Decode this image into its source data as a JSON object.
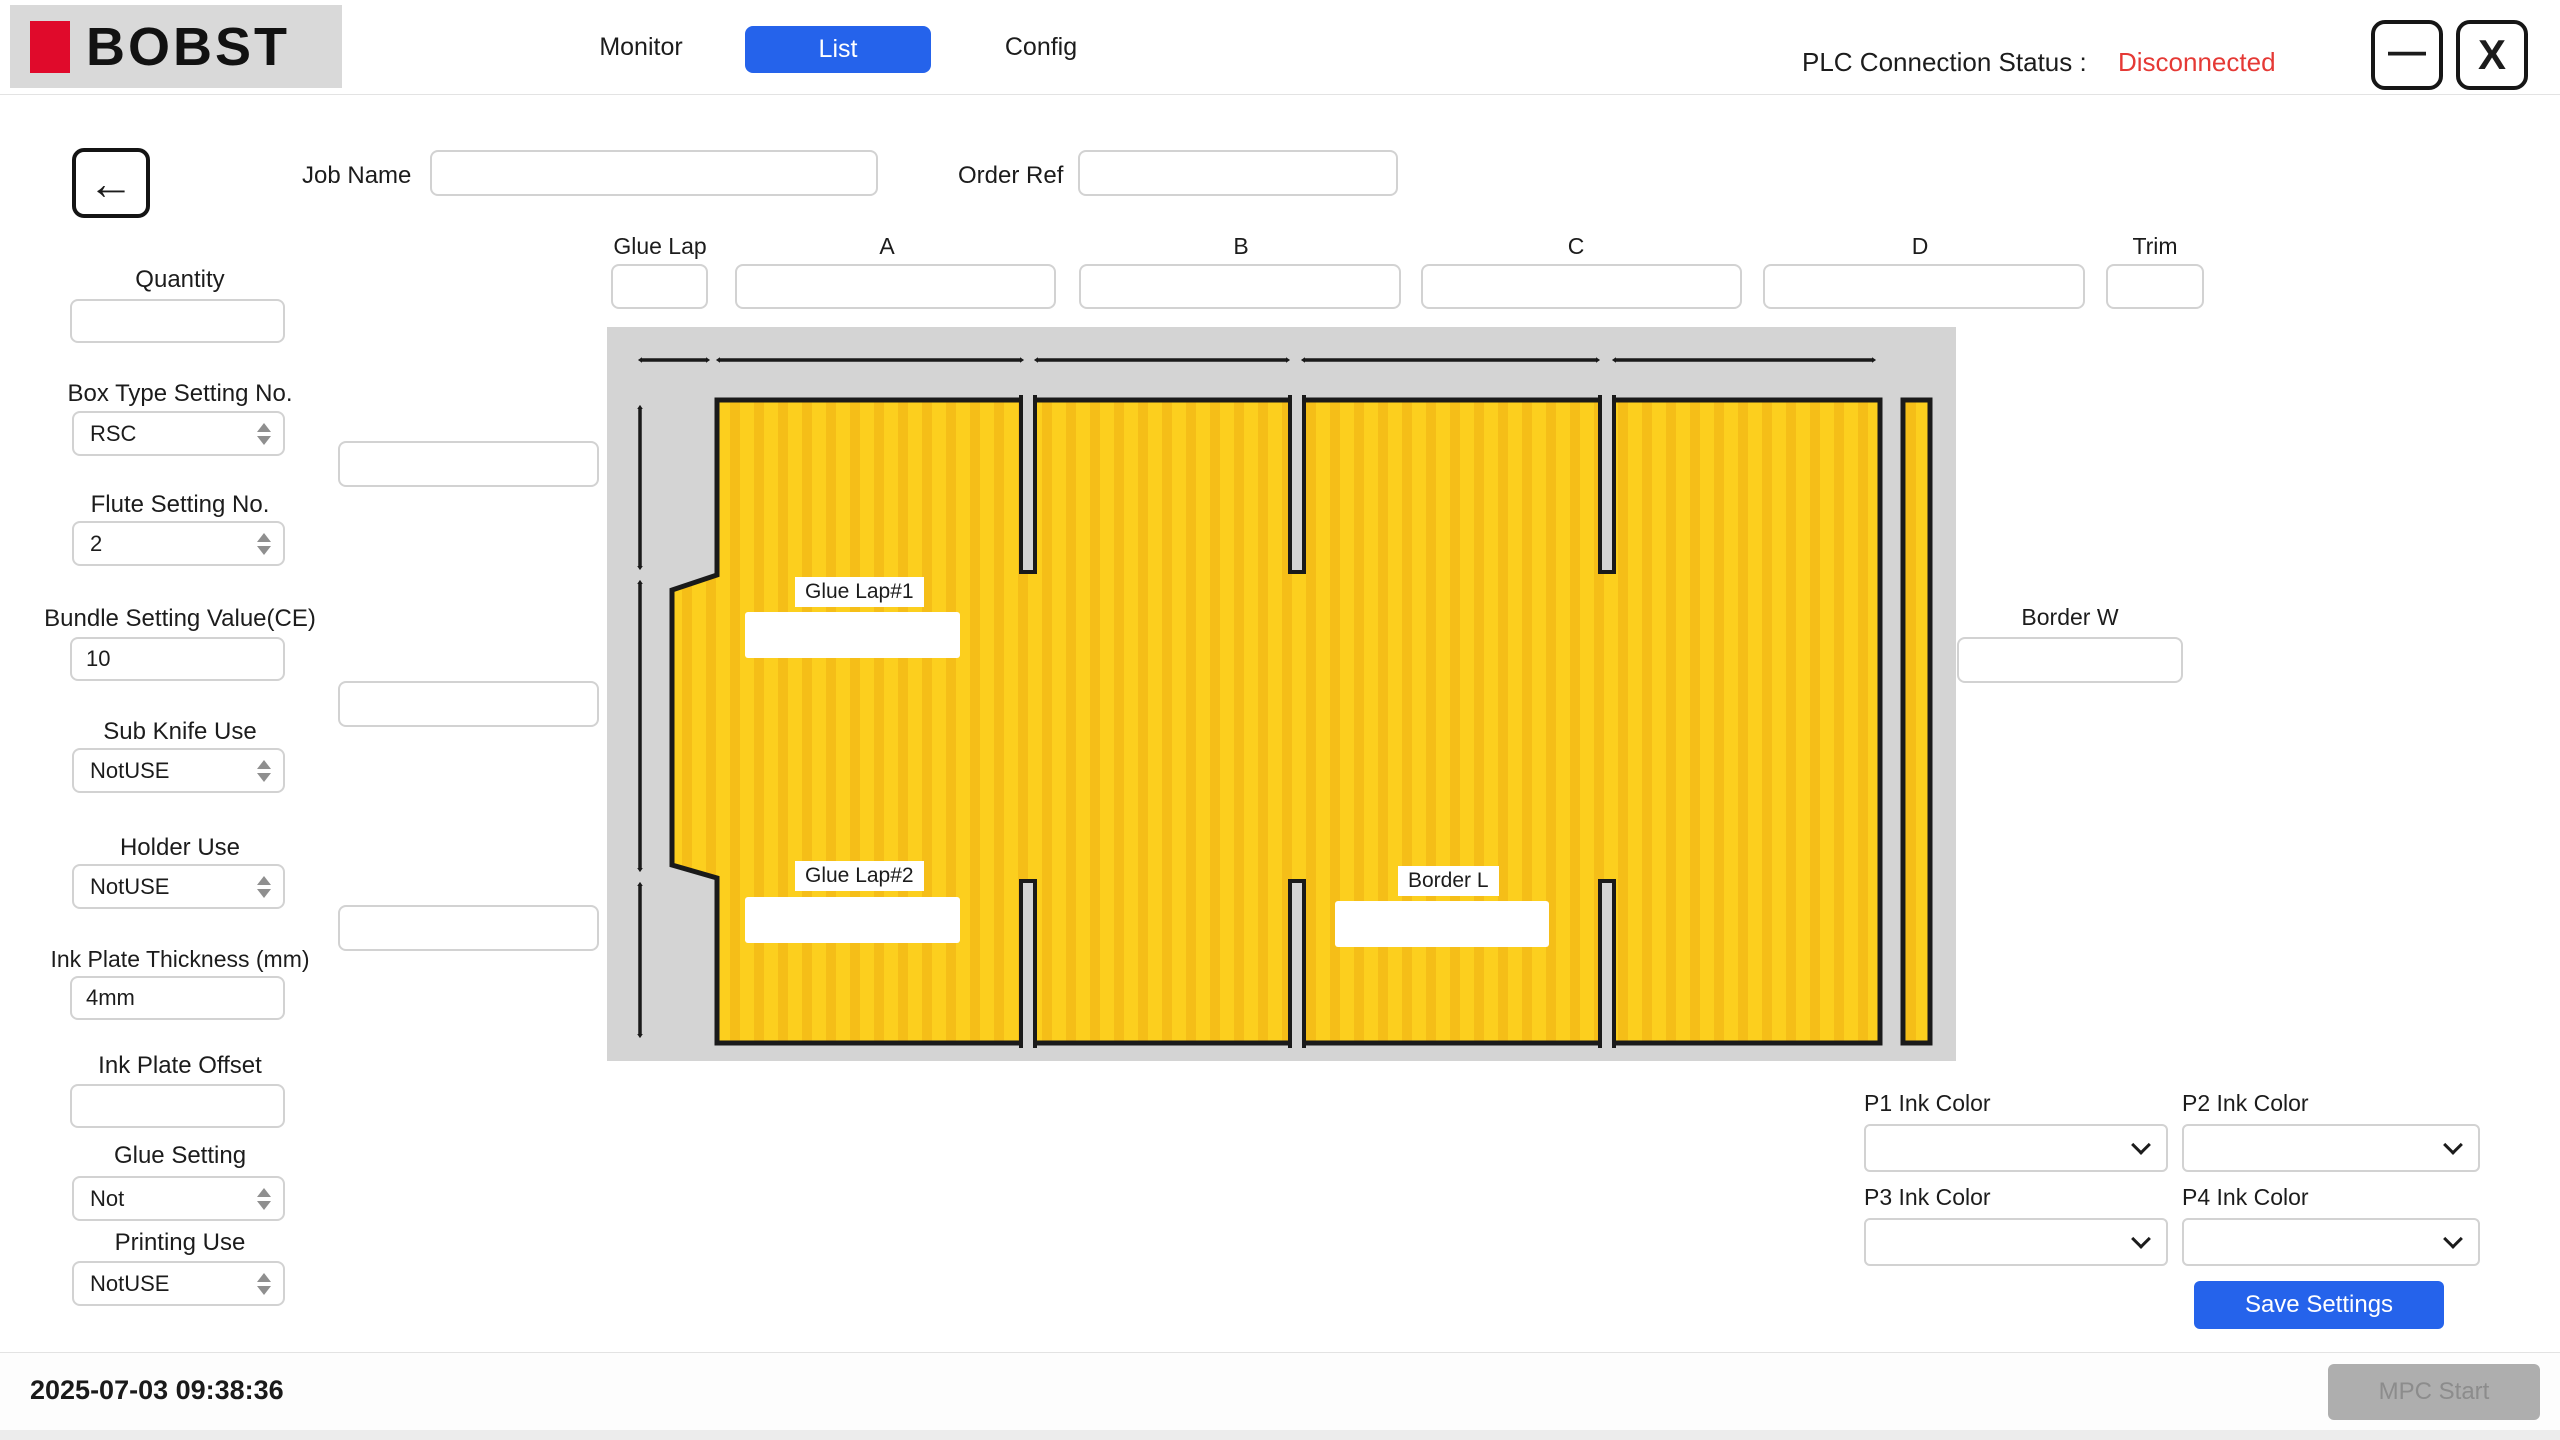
{
  "colors": {
    "accent_blue": "#2563EB",
    "logo_red": "#E00A2B",
    "status_red": "#E53935",
    "diagram_bg": "#D4D4D4",
    "board_yellow": "#FCCF1E",
    "board_stripe": "#F5BE18"
  },
  "header": {
    "brand": "BOBST",
    "tabs": [
      {
        "label": "Monitor"
      },
      {
        "label": "List"
      },
      {
        "label": "Config"
      }
    ],
    "active_tab": "List",
    "plc_label": "PLC Connection Status :",
    "plc_value": "Disconnected",
    "minimize_glyph": "—",
    "close_glyph": "X"
  },
  "nav": {
    "back_glyph": "←"
  },
  "job": {
    "name_label": "Job Name",
    "name_value": "",
    "order_label": "Order Ref",
    "order_value": ""
  },
  "dimensions": {
    "fields": [
      {
        "label": "Glue Lap",
        "value": ""
      },
      {
        "label": "A",
        "value": ""
      },
      {
        "label": "B",
        "value": ""
      },
      {
        "label": "C",
        "value": ""
      },
      {
        "label": "D",
        "value": ""
      },
      {
        "label": "Trim",
        "value": ""
      }
    ]
  },
  "left_panel": {
    "fields": [
      {
        "label": "Quantity",
        "value": "",
        "control": "input"
      },
      {
        "label": "Box Type Setting No.",
        "value": "RSC",
        "control": "stepper-select"
      },
      {
        "label": "Flute Setting No.",
        "value": "2",
        "control": "stepper-select"
      },
      {
        "label": "Bundle Setting Value(CE)",
        "value": "10",
        "control": "input"
      },
      {
        "label": "Sub Knife Use",
        "value": "NotUSE",
        "control": "stepper-select"
      },
      {
        "label": "Holder Use",
        "value": "NotUSE",
        "control": "stepper-select"
      },
      {
        "label": "Ink Plate Thickness (mm)",
        "value": "4mm",
        "control": "input"
      },
      {
        "label": "Ink Plate Offset",
        "value": "",
        "control": "input"
      },
      {
        "label": "Glue Setting",
        "value": "Not",
        "control": "stepper-select"
      },
      {
        "label": "Printing Use",
        "value": "NotUSE",
        "control": "stepper-select"
      }
    ]
  },
  "middle_inputs": [
    {
      "value": ""
    },
    {
      "value": ""
    },
    {
      "value": ""
    }
  ],
  "diagram": {
    "glue_lap1_label": "Glue Lap#1",
    "glue_lap1_value": "",
    "glue_lap2_label": "Glue Lap#2",
    "glue_lap2_value": "",
    "border_l_label": "Border L",
    "border_l_value": ""
  },
  "border_w": {
    "label": "Border W",
    "value": ""
  },
  "ink": {
    "fields": [
      {
        "label": "P1 Ink Color",
        "value": ""
      },
      {
        "label": "P2 Ink Color",
        "value": ""
      },
      {
        "label": "P3 Ink Color",
        "value": ""
      },
      {
        "label": "P4 Ink Color",
        "value": ""
      }
    ],
    "save_label": "Save Settings"
  },
  "footer": {
    "timestamp": "2025-07-03 09:38:36",
    "mpc_start_label": "MPC Start"
  }
}
